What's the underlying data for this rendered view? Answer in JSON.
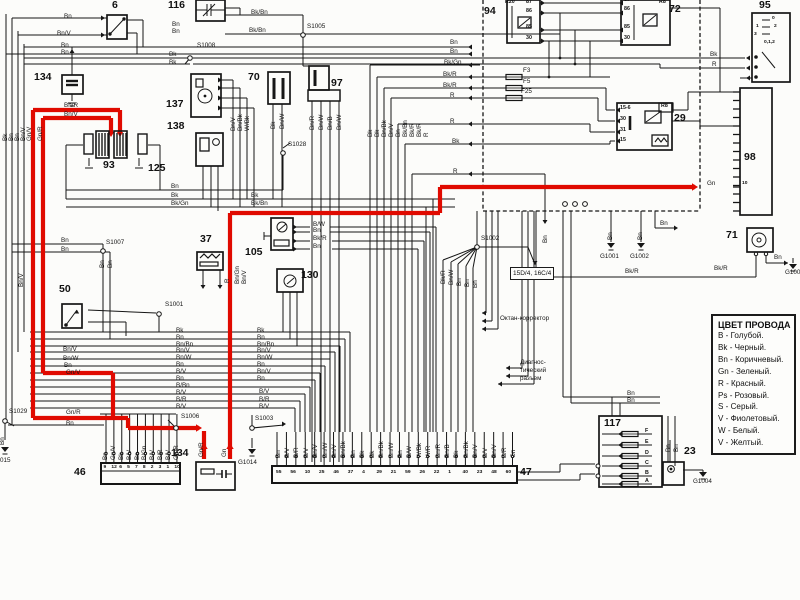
{
  "title": "wiring-diagram-scan",
  "colors": {
    "wire_black": "#161616",
    "wire_red": "#e00a00",
    "bg": "#fcfcfa"
  },
  "legend": {
    "title": "ЦВЕТ ПРОВОДА",
    "entries": [
      "B - Голубой.",
      "Bk - Черный.",
      "Bn - Коричневый.",
      "Gn - Зеленый.",
      "R - Красный.",
      "Ps - Розовый.",
      "S - Серый.",
      "V - Фиолетовый.",
      "W - Белый.",
      "V - Желтый."
    ]
  },
  "annotations": {
    "octane": {
      "text": "Октан-корректор",
      "x": 500,
      "y": 316
    },
    "diag": [
      {
        "text": "Диагнос-",
        "x": 520,
        "y": 360
      },
      {
        "text": "тический",
        "x": 520,
        "y": 368
      },
      {
        "text": "разъем",
        "x": 520,
        "y": 376
      }
    ],
    "conn_ref": {
      "text": "15D/4, 16C/4",
      "x": 510,
      "y": 267
    }
  },
  "components": [
    {
      "id": "6",
      "label": "6",
      "lx": 112,
      "ly": 0,
      "box": [
        107,
        15,
        20,
        24
      ]
    },
    {
      "id": "116",
      "label": "116",
      "lx": 168,
      "ly": 0,
      "box": [
        196,
        0,
        29,
        21
      ]
    },
    {
      "id": "134a",
      "label": "134",
      "lx": 34,
      "ly": 72,
      "box": [
        62,
        75,
        21,
        19
      ]
    },
    {
      "id": "93",
      "label": "93",
      "lx": 103,
      "ly": 160,
      "box": null
    },
    {
      "id": "125",
      "label": "125",
      "lx": 148,
      "ly": 163,
      "box": null
    },
    {
      "id": "137",
      "label": "137",
      "lx": 166,
      "ly": 99,
      "box": [
        191,
        74,
        30,
        43
      ]
    },
    {
      "id": "138",
      "label": "138",
      "lx": 167,
      "ly": 121,
      "box": [
        196,
        133,
        27,
        33
      ]
    },
    {
      "id": "70",
      "label": "70",
      "lx": 248,
      "ly": 72,
      "box": [
        268,
        72,
        22,
        32
      ]
    },
    {
      "id": "97",
      "label": "97",
      "lx": 331,
      "ly": 78,
      "box": [
        309,
        66,
        20,
        24
      ]
    },
    {
      "id": "37",
      "label": "37",
      "lx": 200,
      "ly": 234,
      "box": [
        197,
        252,
        26,
        18
      ]
    },
    {
      "id": "105",
      "label": "105",
      "lx": 245,
      "ly": 247,
      "box": [
        271,
        218,
        22,
        32
      ]
    },
    {
      "id": "130",
      "label": "130",
      "lx": 301,
      "ly": 270,
      "box": [
        277,
        269,
        26,
        23
      ]
    },
    {
      "id": "50",
      "label": "50",
      "lx": 59,
      "ly": 284,
      "box": [
        62,
        304,
        20,
        24
      ]
    },
    {
      "id": "94",
      "label": "94",
      "lx": 484,
      "ly": 6,
      "box": [
        507,
        0,
        33,
        43
      ],
      "pins": [
        "87",
        "86",
        "85",
        "30"
      ],
      "tag": "R20"
    },
    {
      "id": "72",
      "label": "72",
      "lx": 669,
      "ly": 4,
      "box": [
        621,
        0,
        49,
        45
      ],
      "pins": [
        "87",
        "86",
        "85",
        "30"
      ],
      "tag": "R8"
    },
    {
      "id": "29",
      "label": "29",
      "lx": 674,
      "ly": 113,
      "box": [
        617,
        103,
        55,
        47
      ],
      "pins": [
        "15-6",
        "30",
        "31",
        "15"
      ],
      "tag": "R8"
    },
    {
      "id": "95",
      "label": "95",
      "lx": 759,
      "ly": 0,
      "box": [
        752,
        13,
        38,
        69
      ],
      "positions": [
        "0",
        "1",
        "2",
        "3",
        "0,1,2"
      ]
    },
    {
      "id": "98",
      "label": "98",
      "lx": 744,
      "ly": 152,
      "box": [
        740,
        88,
        32,
        127
      ],
      "pin": "10"
    },
    {
      "id": "71",
      "label": "71",
      "lx": 726,
      "ly": 230,
      "box": [
        747,
        228,
        26,
        24
      ]
    },
    {
      "id": "117",
      "label": "117",
      "lx": 604,
      "ly": 418,
      "box": [
        599,
        416,
        63,
        71
      ],
      "fuses": [
        "F",
        "E",
        "D",
        "C",
        "B",
        "A"
      ]
    },
    {
      "id": "23",
      "label": "23",
      "lx": 684,
      "ly": 446,
      "box": [
        663,
        462,
        21,
        23
      ]
    },
    {
      "id": "134b",
      "label": "134",
      "lx": 171,
      "ly": 448,
      "box": [
        196,
        462,
        39,
        28
      ]
    }
  ],
  "strip46": {
    "label": "46",
    "lx": 74,
    "ly": 467,
    "box": [
      101,
      463,
      79,
      21
    ],
    "pins": [
      "9",
      "12",
      "6",
      "5",
      "7",
      "8",
      "2",
      "3",
      "1",
      "10"
    ],
    "wire_labels": [
      "Bn",
      "Gn/V",
      "Bk",
      "B/V",
      "Bn",
      "B/Gn",
      "B/V",
      "B/R",
      "B/V",
      "Gn/R"
    ]
  },
  "strip47": {
    "label": "47",
    "lx": 520,
    "ly": 467,
    "box": [
      272,
      466,
      245,
      17
    ],
    "pins": [
      "55",
      "56",
      "10",
      "25",
      "46",
      "37",
      "4",
      "29",
      "21",
      "59",
      "26",
      "22",
      "1",
      "40",
      "23",
      "48",
      "60"
    ],
    "wire_labels": [
      "Bn",
      "B/V",
      "B/R",
      "B/V",
      "Bn/V",
      "Bn/W",
      "Bn/V",
      "Bn/Bk",
      "Bn",
      "Bk",
      "Bk",
      "Bn/Bk",
      "Bn/W",
      "Bn",
      "B/W",
      "W/Bk",
      "W/R",
      "Bn/R",
      "Bn/B",
      "Bk",
      "Bn/Bk",
      "Bn/V",
      "B/V",
      "Bn/V",
      "B/R",
      "Gn"
    ]
  },
  "fuses": [
    {
      "t": "F3",
      "x": 523,
      "y": 68
    },
    {
      "t": "F5",
      "x": 523,
      "y": 79
    },
    {
      "t": "F25",
      "x": 521,
      "y": 89
    }
  ],
  "junctions": [
    {
      "id": "S1008",
      "x": 197,
      "y": 43,
      "cx": 190,
      "cy": 58
    },
    {
      "id": "S1005",
      "x": 307,
      "y": 24,
      "cx": 303,
      "cy": 35
    },
    {
      "id": "S1007",
      "x": 106,
      "y": 240,
      "cx": 103,
      "cy": 251
    },
    {
      "id": "S1028",
      "x": 288,
      "y": 142,
      "cx": 283,
      "cy": 153
    },
    {
      "id": "S1001",
      "x": 165,
      "y": 302,
      "cx": 159,
      "cy": 314
    },
    {
      "id": "S1002",
      "x": 481,
      "y": 236,
      "cx": 477,
      "cy": 247
    },
    {
      "id": "S1006",
      "x": 181,
      "y": 414,
      "cx": 176,
      "cy": 428
    },
    {
      "id": "S1003",
      "x": 255,
      "y": 416,
      "cx": 252,
      "cy": 428
    },
    {
      "id": "S1029",
      "x": 9,
      "y": 409,
      "cx": 5,
      "cy": 421
    }
  ],
  "grounds": [
    {
      "id": "G1001",
      "x": 600,
      "y": 254,
      "sx": 611,
      "sy": 243
    },
    {
      "id": "G1002",
      "x": 630,
      "y": 254,
      "sx": 641,
      "sy": 243
    },
    {
      "id": "G1014",
      "x": 238,
      "y": 460,
      "sx": 252,
      "sy": 449
    },
    {
      "id": "G1004",
      "x": 693,
      "y": 479,
      "sx": 703,
      "sy": 472
    },
    {
      "id": "015",
      "x": 0,
      "y": 458,
      "sx": 5,
      "sy": 447
    },
    {
      "id": "G1003",
      "x": 785,
      "y": 270,
      "sx": 793,
      "sy": 264
    }
  ],
  "wire_labels": [
    {
      "t": "Bn",
      "x": 64,
      "y": 14
    },
    {
      "t": "Bn/V",
      "x": 57,
      "y": 31
    },
    {
      "t": "Bn",
      "x": 61,
      "y": 43
    },
    {
      "t": "Bn",
      "x": 61,
      "y": 50
    },
    {
      "t": "Bn",
      "x": 172,
      "y": 22
    },
    {
      "t": "Bn",
      "x": 172,
      "y": 29
    },
    {
      "t": "Bk",
      "x": 169,
      "y": 52
    },
    {
      "t": "Bk",
      "x": 169,
      "y": 60
    },
    {
      "t": "Bk/Bn",
      "x": 251,
      "y": 10
    },
    {
      "t": "Bk/Bn",
      "x": 249,
      "y": 28
    },
    {
      "t": "Bn/R",
      "x": 64,
      "y": 103
    },
    {
      "t": "Bn/V",
      "x": 64,
      "y": 112
    },
    {
      "t": "Bn",
      "x": 171,
      "y": 184
    },
    {
      "t": "Bk",
      "x": 171,
      "y": 193
    },
    {
      "t": "Bk/Gn",
      "x": 171,
      "y": 201
    },
    {
      "t": "Bk",
      "x": 251,
      "y": 193
    },
    {
      "t": "Bk/Bn",
      "x": 251,
      "y": 201
    },
    {
      "t": "B/W",
      "x": 313,
      "y": 222
    },
    {
      "t": "Bn",
      "x": 313,
      "y": 228
    },
    {
      "t": "Bk/R",
      "x": 313,
      "y": 236
    },
    {
      "t": "Bn",
      "x": 313,
      "y": 244
    },
    {
      "t": "Bn",
      "x": 61,
      "y": 238
    },
    {
      "t": "Bn",
      "x": 61,
      "y": 247
    },
    {
      "t": "Bn/V",
      "x": 63,
      "y": 347
    },
    {
      "t": "Bn/W",
      "x": 63,
      "y": 356
    },
    {
      "t": "Bn",
      "x": 64,
      "y": 363
    },
    {
      "t": "Gn/V",
      "x": 66,
      "y": 370
    },
    {
      "t": "Gn/R",
      "x": 66,
      "y": 410
    },
    {
      "t": "Bn",
      "x": 66,
      "y": 421
    },
    {
      "t": "Bk",
      "x": 176,
      "y": 328
    },
    {
      "t": "Bn",
      "x": 176,
      "y": 335
    },
    {
      "t": "Bn/Bn",
      "x": 176,
      "y": 342
    },
    {
      "t": "Bn/V",
      "x": 176,
      "y": 348
    },
    {
      "t": "Bn/W",
      "x": 176,
      "y": 355
    },
    {
      "t": "Bn",
      "x": 176,
      "y": 362
    },
    {
      "t": "B/V",
      "x": 176,
      "y": 369
    },
    {
      "t": "Bn",
      "x": 176,
      "y": 376
    },
    {
      "t": "B/Bn",
      "x": 176,
      "y": 383
    },
    {
      "t": "B/V",
      "x": 176,
      "y": 390
    },
    {
      "t": "B/R",
      "x": 176,
      "y": 397
    },
    {
      "t": "B/V",
      "x": 176,
      "y": 404
    },
    {
      "t": "Bk",
      "x": 257,
      "y": 328
    },
    {
      "t": "Bn",
      "x": 257,
      "y": 335
    },
    {
      "t": "Bn/Bn",
      "x": 257,
      "y": 342
    },
    {
      "t": "Bn/V",
      "x": 257,
      "y": 348
    },
    {
      "t": "Bn/W",
      "x": 257,
      "y": 355
    },
    {
      "t": "Bn",
      "x": 257,
      "y": 362
    },
    {
      "t": "Bn/V",
      "x": 257,
      "y": 369
    },
    {
      "t": "Bn",
      "x": 257,
      "y": 376
    },
    {
      "t": "B/V",
      "x": 259,
      "y": 389
    },
    {
      "t": "B/R",
      "x": 259,
      "y": 397
    },
    {
      "t": "B/V",
      "x": 259,
      "y": 404
    },
    {
      "t": "Bn",
      "x": 450,
      "y": 40
    },
    {
      "t": "Bn",
      "x": 450,
      "y": 49
    },
    {
      "t": "Bk/Gn",
      "x": 444,
      "y": 60
    },
    {
      "t": "Bk/R",
      "x": 443,
      "y": 72
    },
    {
      "t": "Bk/R",
      "x": 443,
      "y": 83
    },
    {
      "t": "R",
      "x": 450,
      "y": 93
    },
    {
      "t": "R",
      "x": 450,
      "y": 119
    },
    {
      "t": "Bk",
      "x": 452,
      "y": 139
    },
    {
      "t": "R",
      "x": 453,
      "y": 169
    },
    {
      "t": "Bk",
      "x": 710,
      "y": 52
    },
    {
      "t": "R",
      "x": 712,
      "y": 62
    },
    {
      "t": "Gn",
      "x": 707,
      "y": 181
    },
    {
      "t": "Bk/R",
      "x": 714,
      "y": 266
    },
    {
      "t": "Bn",
      "x": 774,
      "y": 255
    },
    {
      "t": "Bn",
      "x": 627,
      "y": 391
    },
    {
      "t": "Bn",
      "x": 627,
      "y": 398
    },
    {
      "t": "Bk/R",
      "x": 625,
      "y": 269
    },
    {
      "t": "Bn",
      "x": 660,
      "y": 221
    }
  ],
  "wire_labels_rot": [
    {
      "t": "Bk",
      "x": 3,
      "y": 141
    },
    {
      "t": "Bn",
      "x": 9,
      "y": 141
    },
    {
      "t": "Bn",
      "x": 15,
      "y": 141
    },
    {
      "t": "Bn/V",
      "x": 21,
      "y": 141
    },
    {
      "t": "Gn/V",
      "x": 27,
      "y": 141
    },
    {
      "t": "Gn/R",
      "x": 38,
      "y": 141
    },
    {
      "t": "Bn",
      "x": 100,
      "y": 268
    },
    {
      "t": "Bn",
      "x": 108,
      "y": 268
    },
    {
      "t": "Bn/V",
      "x": 231,
      "y": 131
    },
    {
      "t": "Bn/Bk",
      "x": 238,
      "y": 131
    },
    {
      "t": "W/Bk",
      "x": 245,
      "y": 131
    },
    {
      "t": "Bk",
      "x": 271,
      "y": 129
    },
    {
      "t": "Bn/W",
      "x": 280,
      "y": 129
    },
    {
      "t": "Bn/R",
      "x": 310,
      "y": 130
    },
    {
      "t": "Bn/W",
      "x": 319,
      "y": 130
    },
    {
      "t": "Bn/B",
      "x": 328,
      "y": 130
    },
    {
      "t": "Bn/W",
      "x": 337,
      "y": 130
    },
    {
      "t": "Bk",
      "x": 368,
      "y": 137
    },
    {
      "t": "Bk",
      "x": 375,
      "y": 137
    },
    {
      "t": "Bn/Bk",
      "x": 382,
      "y": 137
    },
    {
      "t": "Bn/V",
      "x": 389,
      "y": 137
    },
    {
      "t": "Bn",
      "x": 396,
      "y": 137
    },
    {
      "t": "Bk/Bn",
      "x": 403,
      "y": 137
    },
    {
      "t": "Bk/R",
      "x": 410,
      "y": 137
    },
    {
      "t": "Bk/R",
      "x": 417,
      "y": 137
    },
    {
      "t": "R",
      "x": 424,
      "y": 137
    },
    {
      "t": "Bn/Gn",
      "x": 235,
      "y": 284
    },
    {
      "t": "Bn/V",
      "x": 242,
      "y": 284
    },
    {
      "t": "R",
      "x": 225,
      "y": 283
    },
    {
      "t": "Bn/V",
      "x": 19,
      "y": 287
    },
    {
      "t": "Bk/R",
      "x": 441,
      "y": 284
    },
    {
      "t": "Bn/W",
      "x": 449,
      "y": 285
    },
    {
      "t": "Bn",
      "x": 457,
      "y": 286
    },
    {
      "t": "Bn",
      "x": 465,
      "y": 287
    },
    {
      "t": "Bn",
      "x": 473,
      "y": 288
    },
    {
      "t": "Bn",
      "x": 543,
      "y": 243
    },
    {
      "t": "Bn",
      "x": 608,
      "y": 240
    },
    {
      "t": "Bn",
      "x": 638,
      "y": 240
    },
    {
      "t": "Bn",
      "x": 666,
      "y": 452
    },
    {
      "t": "Bn",
      "x": 674,
      "y": 452
    },
    {
      "t": "Bn",
      "x": 0,
      "y": 445
    },
    {
      "t": "Gn/R",
      "x": 199,
      "y": 457
    },
    {
      "t": "Gn",
      "x": 222,
      "y": 457
    }
  ]
}
